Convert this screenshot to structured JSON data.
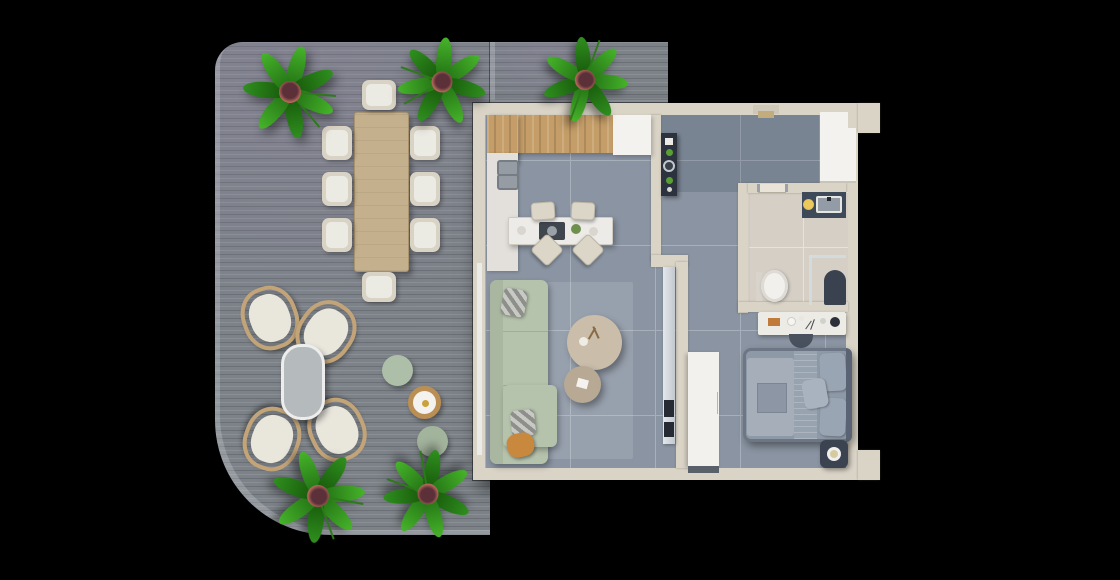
{
  "scene": {
    "type": "3d-floor-plan-render",
    "description": "Top-down 3D architectural render of a one-bedroom apartment with a large wrap-around grey wood deck terrace, on a black background",
    "background": "#000000"
  },
  "palette": {
    "background": "#000000",
    "deck": "#7c8288",
    "deck_edge": "#d6dbe2",
    "wall": "#dad4c7",
    "floor_tile": "#8a94a2",
    "tile_joint": "#a7afba",
    "bathroom_floor": "#d5cfc6",
    "bathroom_grout": "#e8e3da",
    "wood_cabinet": "#c49d68",
    "white_cabinet": "#f3f2ef",
    "marble_counter": "#e3e0db",
    "island_marble": "#edebe7",
    "sofa": "#b5c2ac",
    "sofa_back": "#a9b7a0",
    "pillow_orange": "#c8893f",
    "rug": "#eef3f7",
    "coffee_table_large": "#cabdaa",
    "coffee_table_small": "#b7a994",
    "tv_console": "#d2d8dc",
    "dark_unit": "#2c333e",
    "bed_frame": "#6d7685",
    "bed_mattress": "#8e99a7",
    "bed_duvet": "#a5aeb9",
    "bed_pillow": "#9aa5b4",
    "headboard": "#5a6373",
    "wardrobe_white": "#f2f1ed",
    "dressing_table": "#edebe6",
    "vanity_dark": "#3e4a59",
    "basin_grey": "#939ca6",
    "gold_accent": "#e0b545",
    "toilet_white": "#f1f0ed",
    "shower_mat": "#3a424f",
    "dining_table_wood": "#c4b08d",
    "dining_chair": "#d9d3c5",
    "chair_cushion": "#ecebe3",
    "rattan_frame": "#c3a478",
    "lounge_cushion": "#e9e6dc",
    "oval_table": "#b5babc",
    "pouf_green_light": "#aebfa9",
    "pouf_green_dark": "#a3b49d",
    "tray_rattan": "#bb8f54",
    "plant_leaf_light": "#46b32a",
    "plant_leaf_dark": "#2f8f1e",
    "plant_pot": "#5c3038",
    "plant_pot_rim": "#b96a5e",
    "nightstand": "#3b4351"
  },
  "layout": {
    "terrace": {
      "position": "left and top-left, L-shaped around apartment",
      "flooring": "grey wood deck planks, rounded outer corners",
      "furniture": [
        "rectangular wood dining table",
        "8 cream dining chairs",
        "4 rattan lounge chairs with white cushions",
        "oval grey coffee table",
        "2 sage-green round poufs",
        "round rattan side table",
        "5 potted palm plants"
      ]
    },
    "kitchen": {
      "position": "top-left of apartment",
      "furniture": [
        "wood upper cabinet run",
        "white cabinet section",
        "left marble counter with double sink",
        "marble island with cooktop",
        "4 cream bar stools"
      ]
    },
    "living_room": {
      "position": "left-center of apartment",
      "furniture": [
        "sage-green sectional sofa with chaise",
        "2 checkered pillows",
        "1 orange pillow",
        "large round beige coffee table",
        "small round coffee table",
        "light rug",
        "TV console strip on dividing wall"
      ]
    },
    "entry_hall": {
      "position": "top-right of apartment",
      "furniture": [
        "dark decor console with plants and plates",
        "white entry closet",
        "entry door in top wall"
      ]
    },
    "bathroom": {
      "position": "right-center of apartment, marble floor",
      "furniture": [
        "dark vanity with grey basin and gold vessel",
        "toilet",
        "glass shower partition",
        "dark shower mat",
        "sliding pocket door"
      ]
    },
    "bedroom": {
      "position": "bottom-right of apartment",
      "furniture": [
        "double bed with grey bedding and pillows",
        "white wardrobe panel",
        "white dressing table with cosmetics",
        "dark semicircular stool",
        "dark nightstand with lamp"
      ]
    }
  }
}
